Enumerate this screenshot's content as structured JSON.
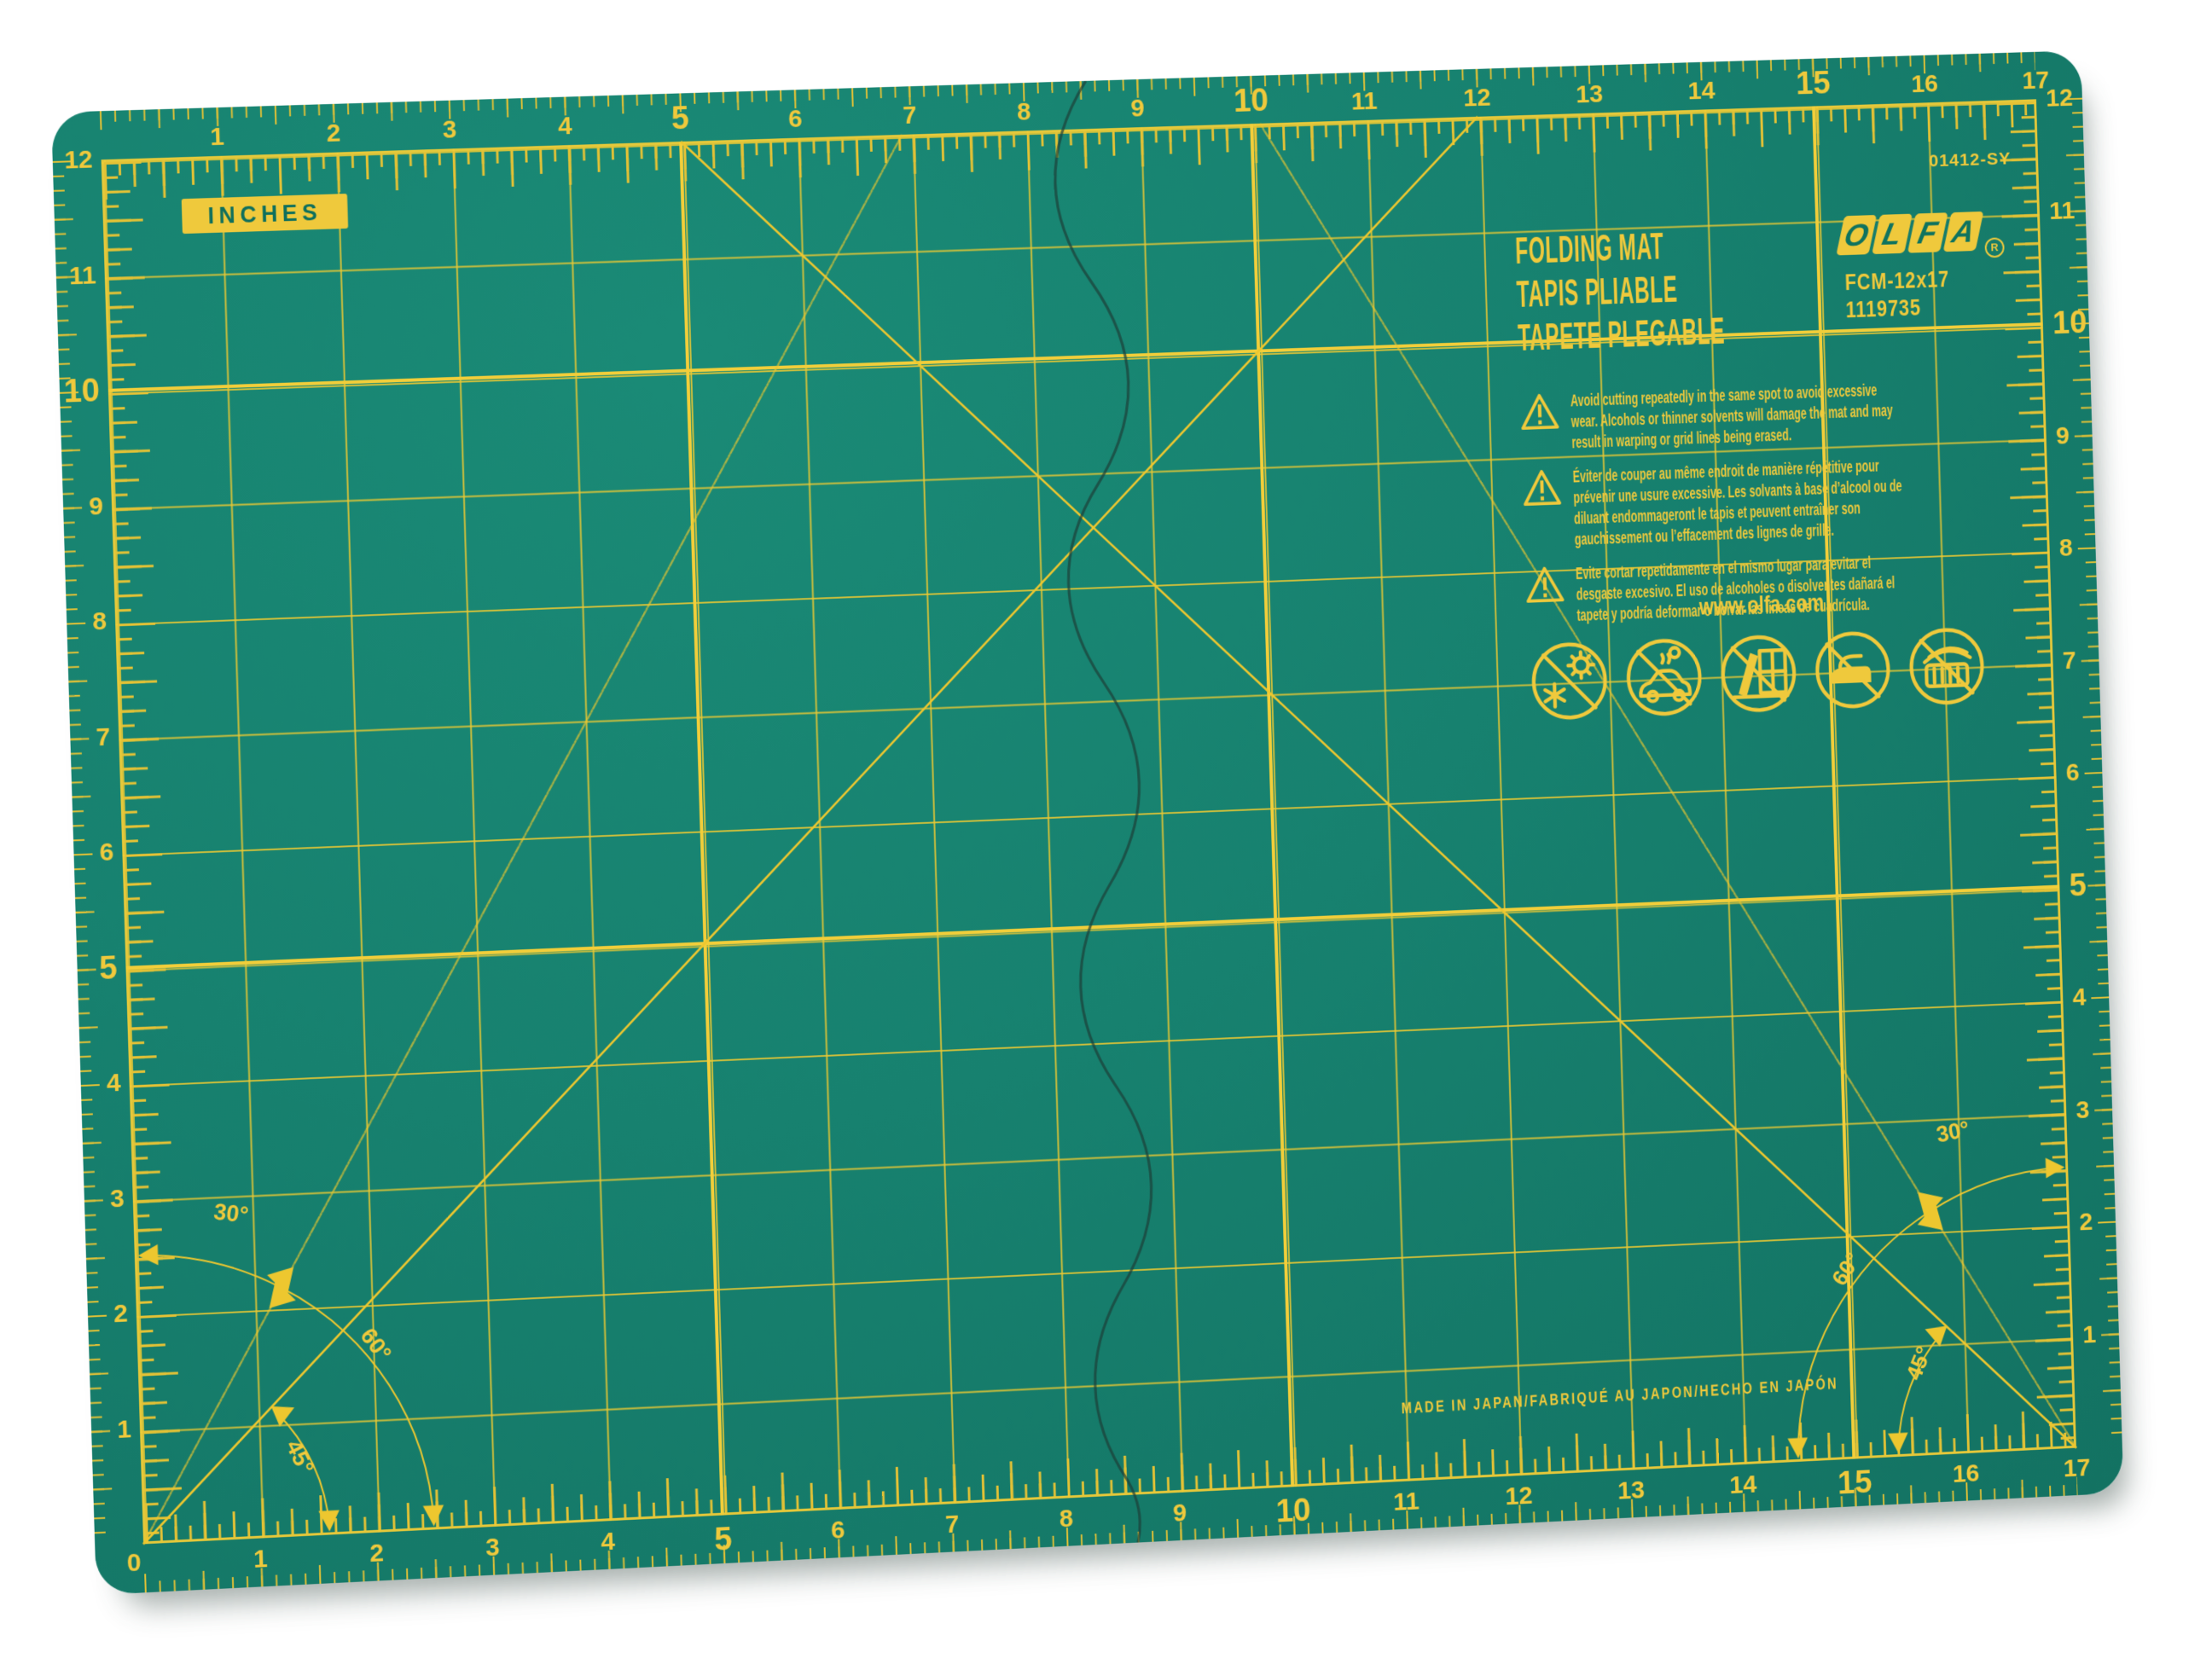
{
  "product": {
    "title_en": "FOLDING MAT",
    "title_fr": "TAPIS PLIABLE",
    "title_es": "TAPETE PLEGABLE",
    "brand": "OLFA",
    "brand_letters": [
      "O",
      "L",
      "F",
      "A"
    ],
    "registered_mark": "R",
    "model": "FCM-12x17",
    "item_number": "1119735",
    "part_code": "01412-SY",
    "website": "www.olfa.com",
    "made_in": "MADE IN JAPAN/FABRIQUÉ AU JAPON/HECHO EN JAPÓN",
    "units_label": "INCHES"
  },
  "warnings": {
    "en": "Avoid cutting repeatedly in the same spot to avoid excessive wear. Alcohols or thinner solvents will damage the mat and may result in warping or grid lines being erased.",
    "fr": "Éviter de couper au même endroit de manière répétitive pour prévenir une usure excessive. Les solvants à base d’alcool ou de diluant endommageront le tapis et peuvent entraîner son gauchissement ou l’effacement des lignes de grille.",
    "es": "Evite cortar repetidamente en el mismo lugar para evitar el desgaste excesivo. El uso de alcoholes o disolventes dañará el tapete y podría deformar o borrar las líneas de cuadrícula."
  },
  "angles": {
    "a30": "30°",
    "a60": "60°",
    "a45": "45°"
  },
  "rulers": {
    "units": "inches",
    "grid_columns": 17,
    "grid_rows": 12,
    "top": [
      "1",
      "2",
      "3",
      "4",
      "5",
      "6",
      "7",
      "8",
      "9",
      "10",
      "11",
      "12",
      "13",
      "14",
      "15",
      "16",
      "17"
    ],
    "bottom": [
      "0",
      "1",
      "2",
      "3",
      "4",
      "5",
      "6",
      "7",
      "8",
      "9",
      "10",
      "11",
      "12",
      "13",
      "14",
      "15",
      "16",
      "17"
    ],
    "left": [
      "1",
      "2",
      "3",
      "4",
      "5",
      "6",
      "7",
      "8",
      "9",
      "10",
      "11",
      "12"
    ],
    "right": [
      "1",
      "2",
      "3",
      "4",
      "5",
      "6",
      "7",
      "8",
      "9",
      "10",
      "11",
      "12"
    ],
    "bold": [
      5,
      10,
      15
    ]
  },
  "icons": [
    "no-sun-or-frost-icon",
    "no-hot-car-icon",
    "no-window-sunlight-icon",
    "no-iron-icon",
    "no-heater-icon",
    "warning-triangle-icon"
  ],
  "colors": {
    "mat_green": "#17816F",
    "print_yellow": "#EFC93C",
    "grid_yellow": "#E4C235",
    "dark_green_text": "#0F735F",
    "fold_line": "#1D3F38",
    "background": "#FFFFFF"
  }
}
